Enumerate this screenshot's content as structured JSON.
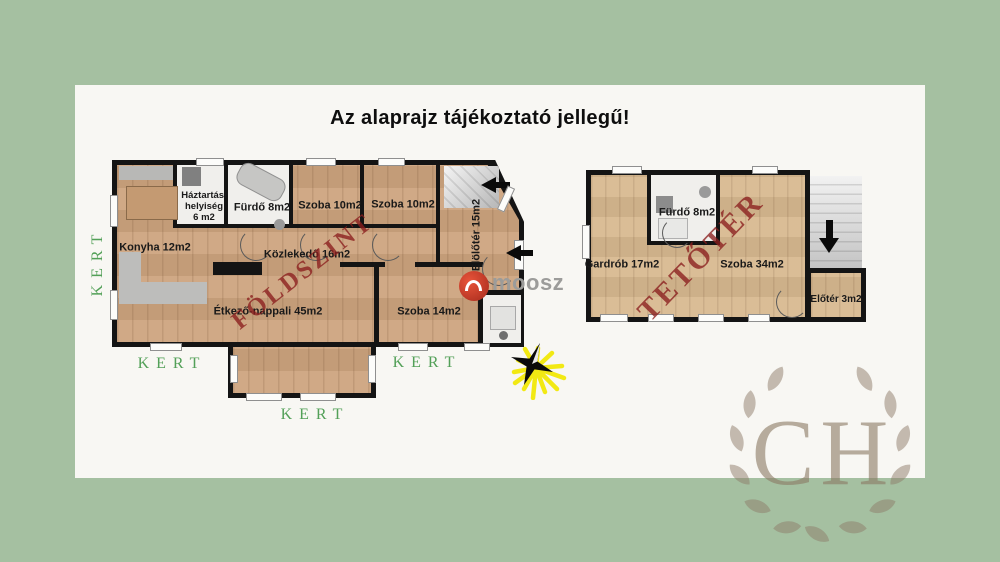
{
  "title": "Az alaprajz tájékoztató jellegű!",
  "ground_floor": {
    "watermark": "FÖLDSZINT",
    "rooms": {
      "konyha": "Konyha 12m2",
      "haztartasi_line1": "Háztartási",
      "haztartasi_line2": "helyiség",
      "haztartasi_line3": "6 m2",
      "furdo": "Fürdő 8m2",
      "szoba_a": "Szoba 10m2",
      "szoba_b": "Szoba 10m2",
      "eloter": "Elölőtér 15m2",
      "kozlekedo": "Közlekedő 16m2",
      "etkezo_nappali": "Étkező-nappali 45m2",
      "szoba_c": "Szoba 14m2"
    }
  },
  "attic": {
    "watermark": "TETŐTÉR",
    "rooms": {
      "furdo": "Fürdő 8m2",
      "gardrob": "Gardrób 17m2",
      "szoba": "Szoba 34m2",
      "eloter": "Előtér 3m2"
    }
  },
  "garden_labels": {
    "left": "KERT",
    "bottom_left": "KERT",
    "bottom_center": "KERT",
    "bottom_right": "KERT"
  },
  "logos": {
    "moosz": "moosz",
    "ch": "CH"
  },
  "colors": {
    "background": "#a5c0a1",
    "panel": "#f8f7f3",
    "wall": "#141414",
    "wood": "#cda47e",
    "watermark_red": "#8b1d1d",
    "garden_green": "#53a058",
    "ch_brown": "#8b7a64",
    "moosz_gray": "#9c9c9a",
    "compass_yellow": "#f2e913"
  }
}
